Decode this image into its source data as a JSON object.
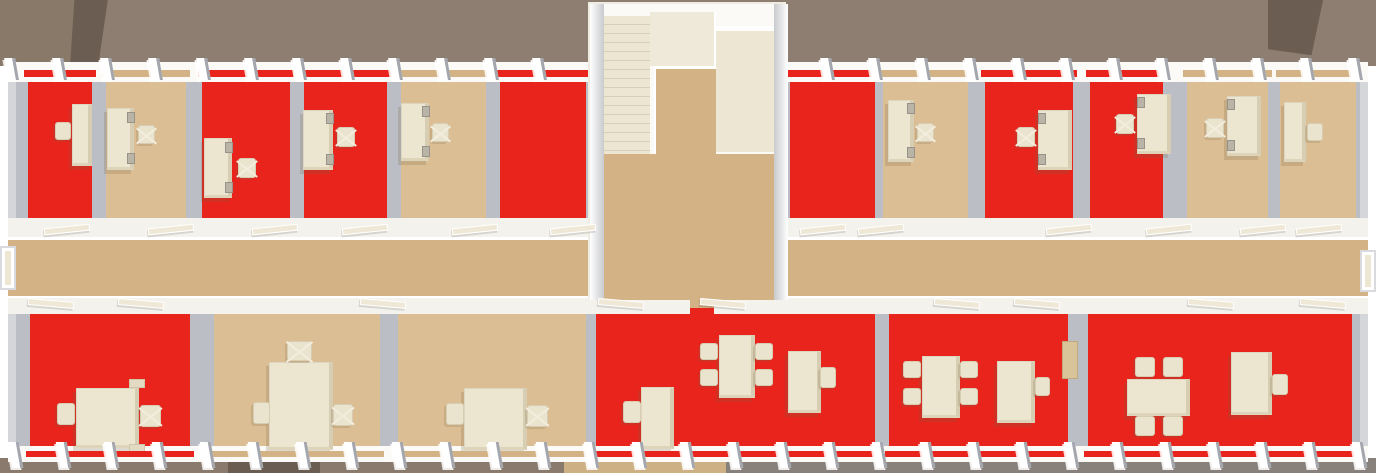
{
  "meta": {
    "description": "Top-down 3D architectural render of one office building floor: two rows of offices with red or tan carpet, a central tan corridor, a central stairwell block, desks, swivel chairs, meeting tables and window piers along both facades.",
    "view": "top-down"
  },
  "palette": {
    "floor_red": "#e8241c",
    "floor_tan": "#dcbe94",
    "corridor_tan": "#d3b285",
    "wall_gray": "#bcbec6",
    "wall_white": "#fbfaf7",
    "band_white": "#f4f2ec",
    "furniture_cream": "#ece5d0",
    "stairs_cream": "#ece6d3",
    "ground_top": "#8d7e71",
    "ground_top_left": "#897969",
    "roof_dark": "#6b5d52",
    "ground_bottom_left": "#8a7a6d",
    "ground_bottom_tan": "#cdb083",
    "ground_bottom_right": "#87807b",
    "ground_shadow": "#6a5c50"
  },
  "scene": {
    "width": 1376,
    "height": 473,
    "rooms_top": [
      {
        "id": "office-1",
        "x": 28,
        "y": 82,
        "w": 64,
        "h": 136,
        "floor": "red",
        "furniture": [
          {
            "type": "desk",
            "x": 72,
            "y": 104,
            "w": 20,
            "h": 62
          },
          {
            "type": "chair",
            "x": 55,
            "y": 122,
            "w": 16,
            "h": 18,
            "swivel": false
          }
        ]
      },
      {
        "id": "office-2",
        "x": 106,
        "y": 82,
        "w": 80,
        "h": 136,
        "floor": "tan",
        "furniture": [
          {
            "type": "desk",
            "x": 107,
            "y": 108,
            "w": 27,
            "h": 62
          },
          {
            "type": "monitor",
            "x": 127,
            "y": 112,
            "w": 8,
            "h": 11
          },
          {
            "type": "monitor",
            "x": 127,
            "y": 153,
            "w": 8,
            "h": 11
          },
          {
            "type": "chair",
            "x": 138,
            "y": 125,
            "w": 17,
            "h": 19,
            "swivel": true
          }
        ]
      },
      {
        "id": "office-3",
        "x": 202,
        "y": 82,
        "w": 88,
        "h": 136,
        "floor": "red",
        "furniture": [
          {
            "type": "desk",
            "x": 204,
            "y": 138,
            "w": 28,
            "h": 60
          },
          {
            "type": "monitor",
            "x": 225,
            "y": 142,
            "w": 8,
            "h": 11
          },
          {
            "type": "monitor",
            "x": 225,
            "y": 182,
            "w": 8,
            "h": 11
          },
          {
            "type": "chair",
            "x": 238,
            "y": 158,
            "w": 18,
            "h": 20,
            "swivel": true
          }
        ]
      },
      {
        "id": "office-4",
        "x": 304,
        "y": 82,
        "w": 83,
        "h": 136,
        "floor": "red",
        "furniture": [
          {
            "type": "desk",
            "x": 303,
            "y": 110,
            "w": 30,
            "h": 60
          },
          {
            "type": "monitor",
            "x": 326,
            "y": 113,
            "w": 8,
            "h": 11
          },
          {
            "type": "monitor",
            "x": 326,
            "y": 154,
            "w": 8,
            "h": 11
          },
          {
            "type": "chair",
            "x": 337,
            "y": 127,
            "w": 18,
            "h": 20,
            "swivel": true
          }
        ]
      },
      {
        "id": "office-5",
        "x": 401,
        "y": 82,
        "w": 85,
        "h": 136,
        "floor": "tan",
        "furniture": [
          {
            "type": "desk",
            "x": 401,
            "y": 103,
            "w": 28,
            "h": 58
          },
          {
            "type": "monitor",
            "x": 422,
            "y": 106,
            "w": 8,
            "h": 11
          },
          {
            "type": "monitor",
            "x": 422,
            "y": 146,
            "w": 8,
            "h": 11
          },
          {
            "type": "chair",
            "x": 432,
            "y": 123,
            "w": 17,
            "h": 19,
            "swivel": true
          }
        ]
      },
      {
        "id": "office-6",
        "x": 500,
        "y": 82,
        "w": 86,
        "h": 136,
        "floor": "red",
        "furniture": []
      },
      {
        "id": "office-7",
        "x": 790,
        "y": 82,
        "w": 85,
        "h": 136,
        "floor": "red",
        "furniture": []
      },
      {
        "id": "office-8",
        "x": 883,
        "y": 82,
        "w": 85,
        "h": 136,
        "floor": "tan",
        "furniture": [
          {
            "type": "desk",
            "x": 888,
            "y": 100,
            "w": 26,
            "h": 62
          },
          {
            "type": "monitor",
            "x": 907,
            "y": 103,
            "w": 8,
            "h": 11
          },
          {
            "type": "monitor",
            "x": 907,
            "y": 147,
            "w": 8,
            "h": 11
          },
          {
            "type": "chair",
            "x": 917,
            "y": 123,
            "w": 17,
            "h": 19,
            "swivel": true
          }
        ]
      },
      {
        "id": "office-9",
        "x": 985,
        "y": 82,
        "w": 88,
        "h": 136,
        "floor": "red",
        "furniture": [
          {
            "type": "desk",
            "x": 1038,
            "y": 110,
            "w": 34,
            "h": 60
          },
          {
            "type": "monitor",
            "x": 1038,
            "y": 113,
            "w": 8,
            "h": 11
          },
          {
            "type": "monitor",
            "x": 1038,
            "y": 154,
            "w": 8,
            "h": 11
          },
          {
            "type": "chair",
            "x": 1017,
            "y": 127,
            "w": 18,
            "h": 20,
            "swivel": true
          }
        ]
      },
      {
        "id": "office-10",
        "x": 1090,
        "y": 82,
        "w": 73,
        "h": 136,
        "floor": "red",
        "furniture": [
          {
            "type": "desk",
            "x": 1137,
            "y": 94,
            "w": 34,
            "h": 60
          },
          {
            "type": "monitor",
            "x": 1137,
            "y": 97,
            "w": 8,
            "h": 11
          },
          {
            "type": "monitor",
            "x": 1137,
            "y": 138,
            "w": 8,
            "h": 11
          },
          {
            "type": "chair",
            "x": 1116,
            "y": 114,
            "w": 18,
            "h": 20,
            "swivel": true
          }
        ]
      },
      {
        "id": "office-11",
        "x": 1187,
        "y": 82,
        "w": 81,
        "h": 136,
        "floor": "tan",
        "furniture": [
          {
            "type": "desk",
            "x": 1227,
            "y": 96,
            "w": 34,
            "h": 60
          },
          {
            "type": "monitor",
            "x": 1227,
            "y": 99,
            "w": 8,
            "h": 11
          },
          {
            "type": "monitor",
            "x": 1227,
            "y": 140,
            "w": 8,
            "h": 11
          },
          {
            "type": "chair",
            "x": 1206,
            "y": 118,
            "w": 18,
            "h": 20,
            "swivel": true
          }
        ]
      },
      {
        "id": "office-12",
        "x": 1280,
        "y": 82,
        "w": 76,
        "h": 136,
        "floor": "tan",
        "furniture": [
          {
            "type": "desk",
            "x": 1284,
            "y": 102,
            "w": 22,
            "h": 60
          },
          {
            "type": "chair",
            "x": 1307,
            "y": 123,
            "w": 16,
            "h": 18,
            "swivel": false
          }
        ]
      }
    ],
    "rooms_bottom": [
      {
        "id": "room-b1",
        "x": 30,
        "y": 312,
        "w": 160,
        "h": 140,
        "floor": "red",
        "furniture": [
          {
            "type": "table",
            "x": 76,
            "y": 388,
            "w": 63,
            "h": 60
          },
          {
            "type": "chair",
            "x": 57,
            "y": 403,
            "w": 18,
            "h": 22,
            "swivel": false
          },
          {
            "type": "chair",
            "x": 140,
            "y": 405,
            "w": 21,
            "h": 22,
            "swivel": true
          },
          {
            "type": "bench",
            "x": 129,
            "y": 379,
            "w": 16,
            "h": 9
          },
          {
            "type": "bench",
            "x": 129,
            "y": 444,
            "w": 16,
            "h": 9
          }
        ]
      },
      {
        "id": "room-b2",
        "x": 214,
        "y": 312,
        "w": 166,
        "h": 140,
        "floor": "tan",
        "furniture": [
          {
            "type": "table",
            "x": 269,
            "y": 362,
            "w": 64,
            "h": 88
          },
          {
            "type": "chair",
            "x": 287,
            "y": 341,
            "w": 25,
            "h": 20,
            "swivel": true
          },
          {
            "type": "chair",
            "x": 253,
            "y": 402,
            "w": 17,
            "h": 22,
            "swivel": false
          },
          {
            "type": "chair",
            "x": 333,
            "y": 404,
            "w": 20,
            "h": 22,
            "swivel": true
          }
        ]
      },
      {
        "id": "room-b3",
        "x": 398,
        "y": 312,
        "w": 188,
        "h": 140,
        "floor": "tan",
        "furniture": [
          {
            "type": "table",
            "x": 464,
            "y": 388,
            "w": 63,
            "h": 62
          },
          {
            "type": "chair",
            "x": 446,
            "y": 403,
            "w": 18,
            "h": 22,
            "swivel": false
          },
          {
            "type": "chair",
            "x": 527,
            "y": 405,
            "w": 21,
            "h": 22,
            "swivel": true
          }
        ]
      },
      {
        "id": "room-b4",
        "x": 596,
        "y": 312,
        "w": 194,
        "h": 140,
        "floor": "red",
        "furniture": [
          {
            "type": "desk",
            "x": 641,
            "y": 387,
            "w": 33,
            "h": 62
          },
          {
            "type": "chair",
            "x": 623,
            "y": 401,
            "w": 18,
            "h": 22,
            "swivel": false
          },
          {
            "type": "table",
            "x": 719,
            "y": 335,
            "w": 36,
            "h": 63
          },
          {
            "type": "chair",
            "x": 700,
            "y": 343,
            "w": 18,
            "h": 17,
            "swivel": false
          },
          {
            "type": "chair",
            "x": 700,
            "y": 369,
            "w": 18,
            "h": 17,
            "swivel": false
          },
          {
            "type": "chair",
            "x": 755,
            "y": 343,
            "w": 18,
            "h": 17,
            "swivel": false
          },
          {
            "type": "chair",
            "x": 755,
            "y": 369,
            "w": 18,
            "h": 17,
            "swivel": false
          }
        ]
      },
      {
        "id": "room-b5",
        "x": 790,
        "y": 312,
        "w": 85,
        "h": 140,
        "floor": "red",
        "furniture": [
          {
            "type": "desk",
            "x": 788,
            "y": 351,
            "w": 33,
            "h": 62
          },
          {
            "type": "chair",
            "x": 820,
            "y": 367,
            "w": 16,
            "h": 21,
            "swivel": false
          }
        ]
      },
      {
        "id": "room-b6",
        "x": 889,
        "y": 312,
        "w": 179,
        "h": 140,
        "floor": "red",
        "furniture": [
          {
            "type": "table",
            "x": 922,
            "y": 356,
            "w": 38,
            "h": 62
          },
          {
            "type": "chair",
            "x": 903,
            "y": 361,
            "w": 18,
            "h": 17,
            "swivel": false
          },
          {
            "type": "chair",
            "x": 903,
            "y": 388,
            "w": 18,
            "h": 17,
            "swivel": false
          },
          {
            "type": "chair",
            "x": 960,
            "y": 361,
            "w": 18,
            "h": 17,
            "swivel": false
          },
          {
            "type": "chair",
            "x": 960,
            "y": 388,
            "w": 18,
            "h": 17,
            "swivel": false
          },
          {
            "type": "desk",
            "x": 997,
            "y": 361,
            "w": 38,
            "h": 62
          },
          {
            "type": "chair",
            "x": 1035,
            "y": 377,
            "w": 15,
            "h": 19,
            "swivel": false
          },
          {
            "type": "cabinet",
            "x": 1062,
            "y": 341,
            "w": 16,
            "h": 38
          }
        ]
      },
      {
        "id": "room-b7",
        "x": 1088,
        "y": 312,
        "w": 264,
        "h": 140,
        "floor": "red",
        "furniture": [
          {
            "type": "table",
            "x": 1127,
            "y": 379,
            "w": 63,
            "h": 37
          },
          {
            "type": "chair",
            "x": 1135,
            "y": 357,
            "w": 20,
            "h": 20,
            "swivel": false
          },
          {
            "type": "chair",
            "x": 1163,
            "y": 357,
            "w": 20,
            "h": 20,
            "swivel": false
          },
          {
            "type": "chair",
            "x": 1135,
            "y": 416,
            "w": 20,
            "h": 20,
            "swivel": false
          },
          {
            "type": "chair",
            "x": 1163,
            "y": 416,
            "w": 20,
            "h": 20,
            "swivel": false
          },
          {
            "type": "desk",
            "x": 1231,
            "y": 352,
            "w": 41,
            "h": 63
          },
          {
            "type": "chair",
            "x": 1272,
            "y": 374,
            "w": 16,
            "h": 21,
            "swivel": false
          }
        ]
      }
    ],
    "corridor": {
      "x": 8,
      "y": 240,
      "w": 1360,
      "h": 56
    },
    "stairwell": {
      "x": 588,
      "y": 2,
      "w": 198,
      "h": 296
    },
    "top_doors_x": [
      44,
      148,
      252,
      342,
      452,
      550,
      800,
      858,
      1046,
      1146,
      1240,
      1296
    ],
    "bottom_doors_x": [
      28,
      118,
      360,
      598,
      700,
      934,
      1014,
      1188,
      1300
    ],
    "door_rows": {
      "top": 226,
      "bottom": 300
    },
    "pier_rows": {
      "top": 58,
      "bottom": 442
    },
    "entrance_doors": [
      {
        "side": "left",
        "x": 0,
        "y": 246,
        "w": 16,
        "h": 44
      },
      {
        "side": "right",
        "x": 1360,
        "y": 250,
        "w": 16,
        "h": 42
      }
    ]
  }
}
